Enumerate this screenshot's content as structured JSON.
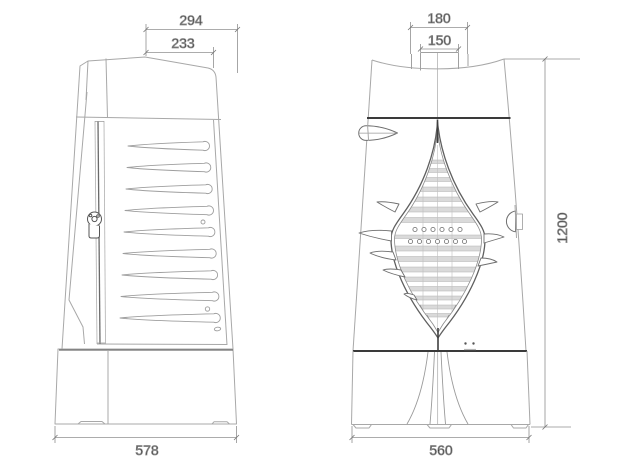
{
  "dimensions": {
    "side_top_outer": "294",
    "side_top_inner": "233",
    "side_base_width": "578",
    "front_flue_outer": "180",
    "front_flue_inner": "150",
    "front_base_width": "560",
    "front_overall_height": "1200"
  },
  "colors": {
    "background": "#ffffff",
    "line_light": "#a8a8a8",
    "line_medium": "#7a7a7a",
    "line_bold": "#3a3a3a",
    "slat_fill": "#dadada",
    "dimension_line": "#909090",
    "dimension_text": "#1c1c1c"
  }
}
